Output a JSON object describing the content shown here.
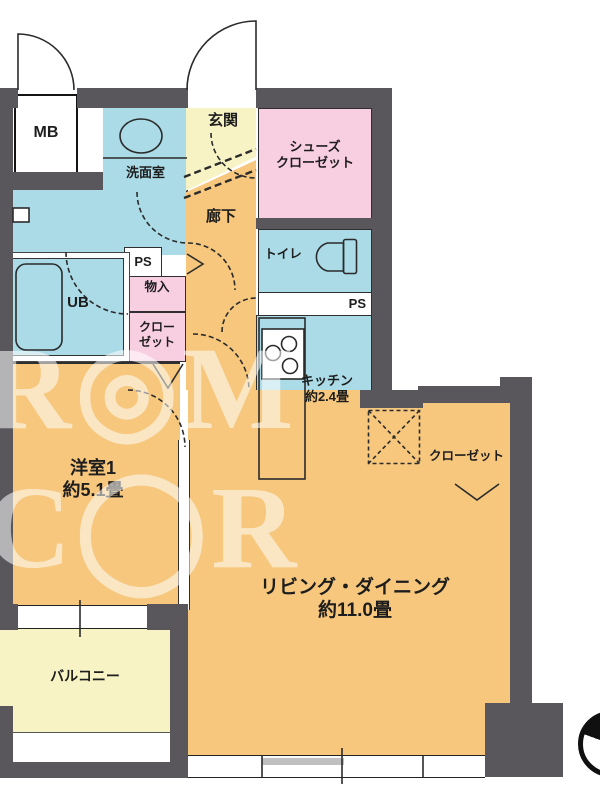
{
  "palette": {
    "wall": "#59575c",
    "room_orange": "#f6c77d",
    "wet_area_blue": "#abdbe7",
    "closet_pink": "#f8cee1",
    "tatami_yellow": "#f7f3c4",
    "outline": "#2b2b2b"
  },
  "watermark": "R◎M C◯R",
  "rooms": {
    "mb": {
      "label": "MB"
    },
    "genkan": {
      "label": "玄関"
    },
    "shoe_closet": {
      "label_line1": "シューズ",
      "label_line2": "クローゼット"
    },
    "washroom": {
      "label": "洗面室"
    },
    "hallway": {
      "label": "廊下"
    },
    "toilet": {
      "label": "トイレ"
    },
    "ps_toilet": {
      "label": "PS"
    },
    "ps_hall": {
      "label": "PS"
    },
    "storage": {
      "label": "物入"
    },
    "ub": {
      "label": "UB"
    },
    "closet_hall": {
      "label_line1": "クロー",
      "label_line2": "ゼット"
    },
    "kitchen": {
      "label": "キッチン",
      "size": "約2.4畳"
    },
    "closet_living": {
      "label": "クローゼット"
    },
    "bedroom": {
      "label": "洋室1",
      "size": "約5.1畳"
    },
    "living": {
      "label": "リビング・ダイニング",
      "size": "約11.0畳"
    },
    "balcony": {
      "label": "バルコニー"
    }
  }
}
